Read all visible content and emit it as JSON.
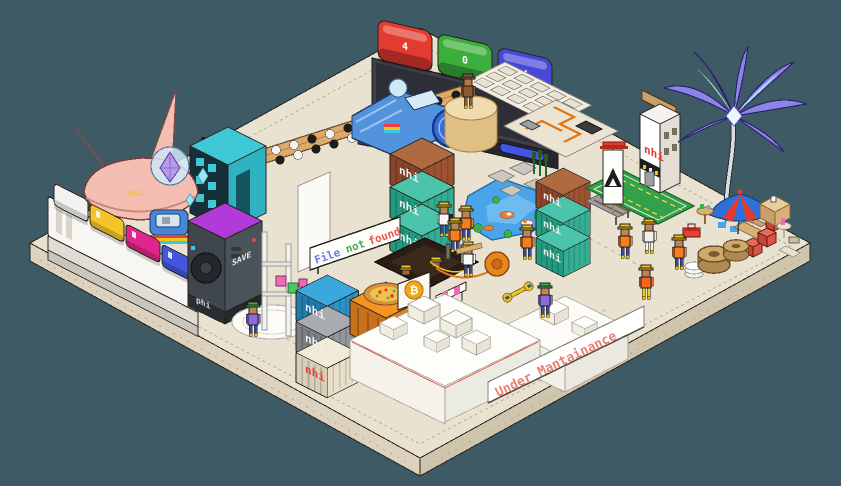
{
  "scene": {
    "background": "#3e5a64",
    "platform": {
      "top": "#eae2d0",
      "side_upper": "#dcd2bd",
      "side_lower": "#cfc4ac",
      "outline": "#26211c",
      "marking": "#b9ae96"
    }
  },
  "signs": {
    "brand": "nhi",
    "phi": "phi",
    "save": "SAVE",
    "tray_code": "L3Π4",
    "bitcoin": "₿",
    "coin": "$",
    "file_not_found": {
      "words": [
        {
          "text": "File",
          "color": "#6a7ce0"
        },
        {
          "text": "not",
          "color": "#44b04c"
        },
        {
          "text": "found",
          "color": "#e8574a"
        }
      ]
    },
    "under_maintenance": {
      "text": "Under Mantainance",
      "color": "#ee7f72"
    }
  },
  "keys404": [
    {
      "glyph": "4",
      "color": "#e23b30"
    },
    {
      "glyph": "0",
      "color": "#3bae3b"
    },
    {
      "glyph": "4",
      "color": "#4747d8"
    }
  ],
  "keyboard_keys": [
    {
      "color": "#f2f2f0"
    },
    {
      "color": "#f4c52a"
    },
    {
      "color": "#e0258c"
    },
    {
      "color": "#4356e0"
    }
  ],
  "container_colors": {
    "brown": {
      "t": "#b06a42",
      "l": "#8a442a",
      "r": "#9c5332"
    },
    "teal": {
      "t": "#4cc4ac",
      "l": "#23997e",
      "r": "#35ad92"
    },
    "blue": {
      "t": "#3aa8dc",
      "l": "#1f7cad",
      "r": "#2b93c6"
    },
    "gray": {
      "t": "#a8acb0",
      "l": "#7c8084",
      "r": "#93979b"
    },
    "cream": {
      "t": "#f2ead8",
      "l": "#d9cfb8",
      "r": "#e8dfc9"
    }
  },
  "label_colors": {
    "light": "#f2f2f2",
    "red": "#e04438",
    "tower": "#e03c30"
  },
  "outfits": {
    "vest": "#f57f20",
    "hat": "#f5c518",
    "skin": "#bd8552",
    "pants": "#3a4a9c",
    "purple": "#8d6bd8",
    "green_hat": "#3fae4c",
    "cream": "#f5f0e6",
    "white": "#f8f8f6",
    "tangerine": "#f26522",
    "yellow_pants": "#e8d020",
    "brown": "#8a5a32",
    "tan_skin": "#b5763f"
  },
  "props": {
    "pond": "#4aa4ea",
    "palm": "#8d84e8",
    "palm_tip": "#aee6f2",
    "lawn": "#33a04a",
    "ship": "#f4beb2",
    "speaker_top": "#b13ad8",
    "teal_cube": "#2fb3c3",
    "crate": "#f5941e",
    "gold": "#f0a818",
    "wood": "#dcaa6a",
    "machine": "#5393dd",
    "umbrella": "#2e6fd8",
    "red": "#e03c30"
  }
}
